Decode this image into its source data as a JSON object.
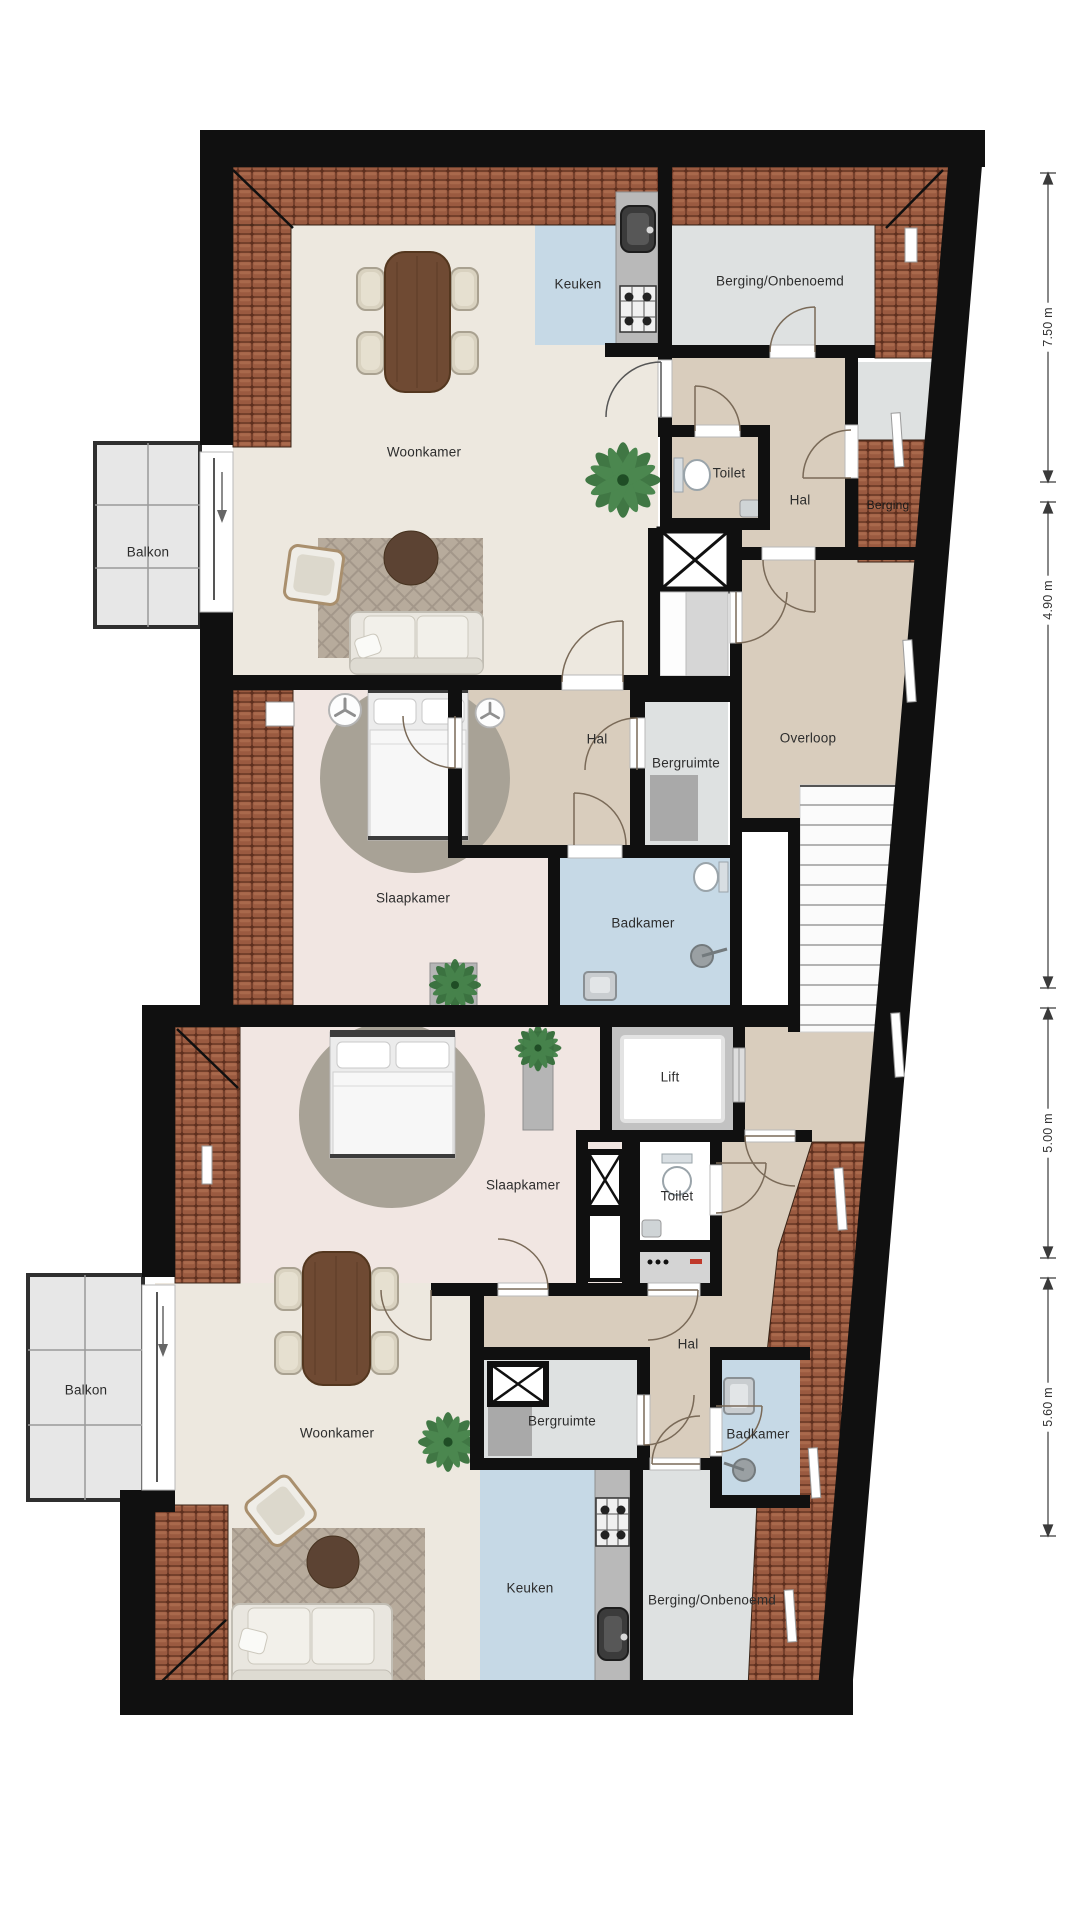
{
  "plan_title": "Floor plan (attic storey with two apartments)",
  "labels": {
    "woonkamer1": "Woonkamer",
    "keuken1": "Keuken",
    "berging_onbenoemd1": "Berging/Onbenoemd",
    "toilet1": "Toilet",
    "hal1_entree": "Hal",
    "berging_zolder": "Berging",
    "balkon1": "Balkon",
    "hal1": "Hal",
    "bergruimte1": "Bergruimte",
    "overloop": "Overloop",
    "slaapkamer1": "Slaapkamer",
    "badkamer1": "Badkamer",
    "lift": "Lift",
    "slaapkamer2": "Slaapkamer",
    "toilet2": "Toilet",
    "hal2": "Hal",
    "balkon2": "Balkon",
    "bergruimte2": "Bergruimte",
    "woonkamer2": "Woonkamer",
    "badkamer2": "Badkamer",
    "keuken2": "Keuken",
    "berging_onbenoemd2": "Berging/Onbenoemd"
  },
  "dimensions": {
    "d1": "7.50 m",
    "d2": "4.90 m",
    "d3": "5.00 m",
    "d4": "5.60 m"
  },
  "colors": {
    "wall": "#101010",
    "floor_living": "#EDE8DF",
    "floor_bedroom": "#F1E6E2",
    "floor_hall": "#D9CDBD",
    "floor_wet": "#C6D9E6",
    "floor_storage": "#DEE1E1",
    "roof_tiles": "#9A5A40",
    "balcony": "#E7E7E7",
    "dimension_line": "#3a3a3a"
  }
}
